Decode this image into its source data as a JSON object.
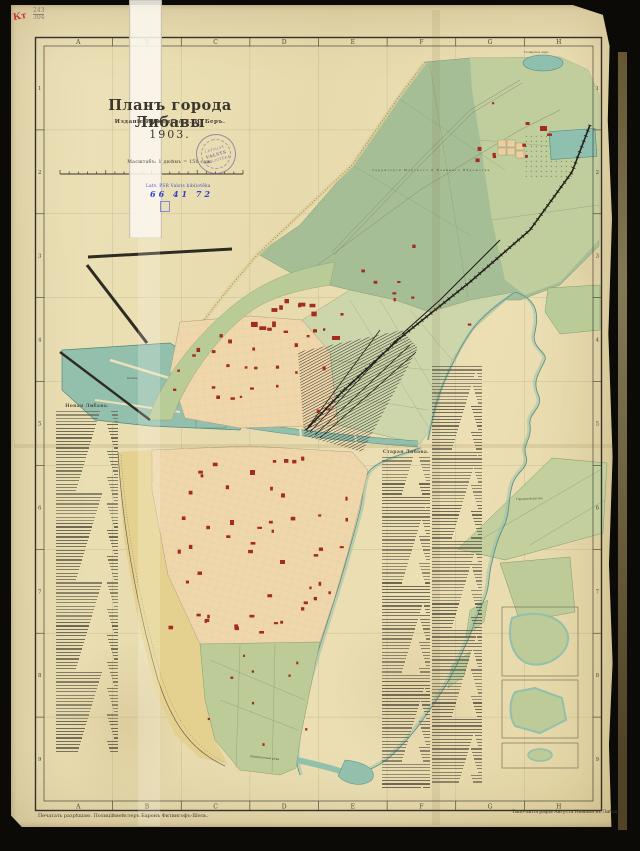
{
  "scan": {
    "corner_mark_red": "Кт",
    "corner_fraction_top": "243",
    "corner_fraction_bottom": "304"
  },
  "title_block": {
    "title": "Планъ города Либавы",
    "subtitle": "Изданіе Инженера Е. И. Беръ.",
    "year": "1903.",
    "scale_label": "Масштабъ: 1 дюймъ = 150 саж."
  },
  "stamps": {
    "round_top": "LATVIJAS",
    "round_mid": "VALSTS",
    "round_bottom": "BIBLIOTĒKA",
    "library_line": "Latv. PSR Valsts bibliotēka",
    "inventory_number": "66 41 72"
  },
  "grid": {
    "columns": [
      "A",
      "B",
      "C",
      "D",
      "E",
      "F",
      "G",
      "H"
    ],
    "rows": [
      "1",
      "2",
      "3",
      "4",
      "5",
      "6",
      "7",
      "8",
      "9"
    ]
  },
  "map_labels": {
    "military_territory": "Территорія Морского и Военнаго Вѣдомства",
    "tosmare_lake": "Тосмарское озеро",
    "kovsh": "Ковшъ",
    "city_pasture": "Городской выгонъ",
    "perkunen_river": "Перкуненская рѣка"
  },
  "street_index": {
    "left": {
      "header": "Новая Либава.",
      "line_count": 104
    },
    "center": {
      "header": "Старая Либава.",
      "line_count": 101
    },
    "right_column": {
      "line_count": 127
    }
  },
  "footer": {
    "left": "Печатать разрѣшаю. Полицiймейстеръ Баронъ Фитингофъ-Шель.",
    "right": "Типо-литографія Августа Нимана въ Либавѣ."
  }
}
